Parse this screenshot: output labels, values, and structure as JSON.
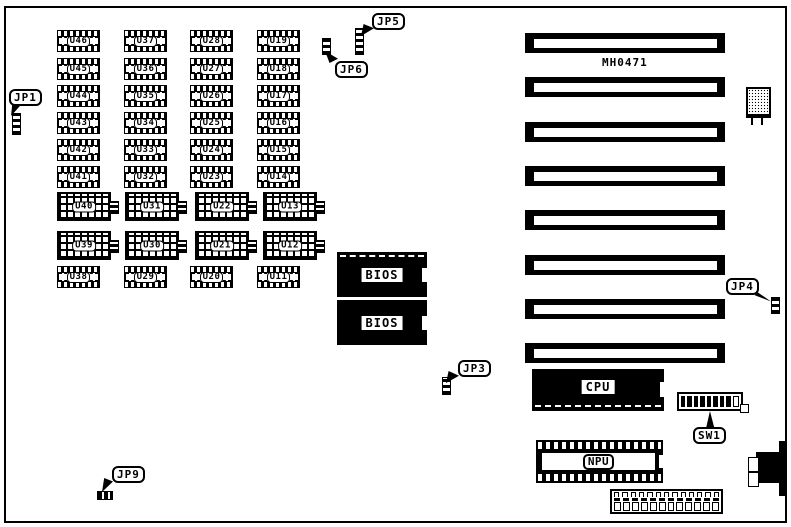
{
  "board": {
    "model_label": "MH0471"
  },
  "chips": {
    "labels": [
      "U46",
      "U45",
      "U44",
      "U43",
      "U42",
      "U41",
      "U40",
      "U39",
      "U38",
      "U37",
      "U36",
      "U35",
      "U34",
      "U33",
      "U32",
      "U31",
      "U30",
      "U29",
      "U28",
      "U27",
      "U26",
      "U25",
      "U24",
      "U23",
      "U22",
      "U21",
      "U20",
      "U19",
      "U18",
      "U17",
      "U16",
      "U15",
      "U14",
      "U13",
      "U12",
      "U11"
    ]
  },
  "rom_chips": {
    "bios1": "BIOS",
    "bios2": "BIOS"
  },
  "cpu": {
    "label": "CPU"
  },
  "npu": {
    "label": "NPU"
  },
  "dip_switch": {
    "label": "SW1",
    "positions": 9
  },
  "jumpers": {
    "jp1": "JP1",
    "jp3": "JP3",
    "jp4": "JP4",
    "jp5": "JP5",
    "jp6": "JP6",
    "jp9": "JP9"
  },
  "expansion_slots": {
    "count": 8
  },
  "colors": {
    "ink": "#000000",
    "background": "#ffffff"
  }
}
